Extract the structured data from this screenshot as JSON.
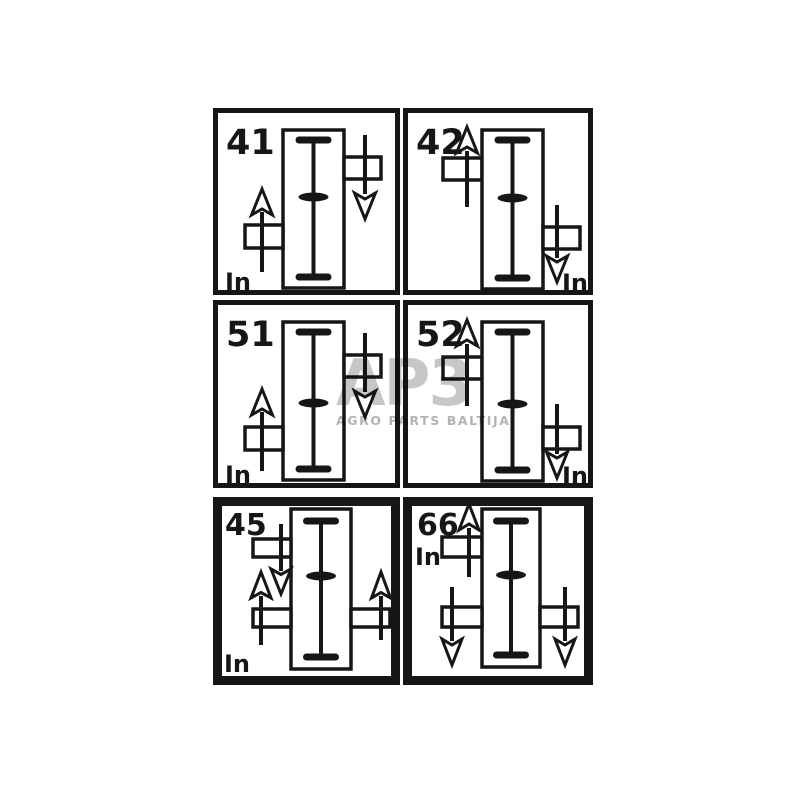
{
  "colors": {
    "ink": "#161616",
    "background": "#ffffff",
    "watermark_logo": "#c7c7c7",
    "watermark_subtitle": "#b3b3b3"
  },
  "watermark": {
    "logo": "AP3",
    "subtitle": "AGRO PARTS BALTIJA"
  },
  "cells": [
    {
      "label": "41",
      "in_label": "In",
      "input": {
        "position": "bottom-left",
        "rotation": "up"
      },
      "outputs": [
        {
          "position": "top-right",
          "rotation": "down"
        }
      ]
    },
    {
      "label": "42",
      "in_label": "In",
      "input": {
        "position": "bottom-right",
        "rotation": "down"
      },
      "outputs": [
        {
          "position": "top-left",
          "rotation": "up"
        }
      ]
    },
    {
      "label": "51",
      "in_label": "In",
      "input": {
        "position": "bottom-left",
        "rotation": "up"
      },
      "outputs": [
        {
          "position": "top-right",
          "rotation": "down"
        }
      ]
    },
    {
      "label": "52",
      "in_label": "In",
      "input": {
        "position": "bottom-right",
        "rotation": "down"
      },
      "outputs": [
        {
          "position": "top-left",
          "rotation": "up"
        }
      ]
    },
    {
      "label": "45",
      "in_label": "In",
      "input": {
        "position": "bottom-left",
        "rotation": "up"
      },
      "outputs": [
        {
          "position": "top-left",
          "rotation": "down"
        },
        {
          "position": "bottom-right",
          "rotation": "up"
        }
      ]
    },
    {
      "label": "66",
      "in_label": "In",
      "input": {
        "position": "top-left",
        "rotation": "up"
      },
      "outputs": [
        {
          "position": "bottom-left",
          "rotation": "down"
        },
        {
          "position": "bottom-right",
          "rotation": "down"
        }
      ]
    }
  ]
}
